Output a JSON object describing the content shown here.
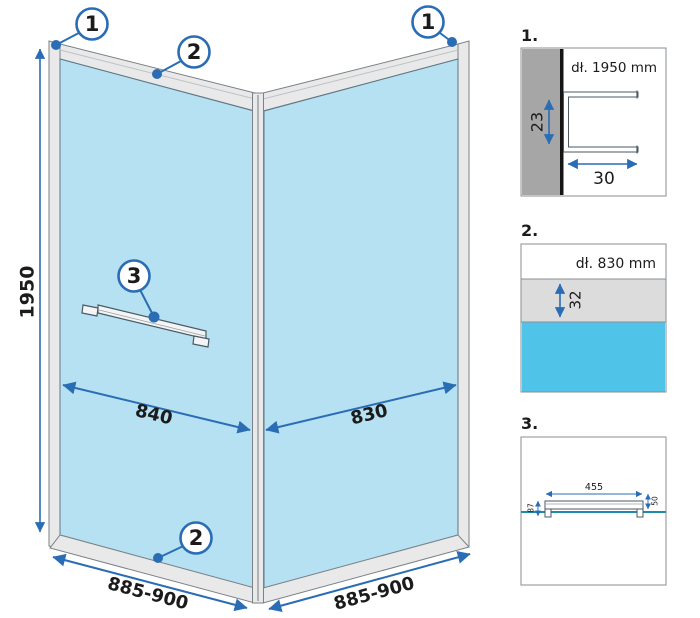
{
  "colors": {
    "accent_blue": "#2a6db5",
    "glass_blue": "#b6e1f2",
    "deep_blue": "#4fc3e8",
    "teal_line": "#1d8cab",
    "wall_gray": "#a6a6a6",
    "band_gray": "#dcdcdc",
    "frame_gray": "#e9e9e9"
  },
  "main": {
    "callout_top_left": "1",
    "callout_top_rail": "2",
    "callout_top_right": "1",
    "callout_shelf": "3",
    "callout_bottom_rail": "2",
    "dim_height": "1950",
    "dim_left_glass": "840",
    "dim_right_glass": "830",
    "dim_left_width": "885-900",
    "dim_right_width": "885-900"
  },
  "detail1": {
    "label": "1.",
    "profile_length": "dł. 1950 mm",
    "dim_depth": "23",
    "dim_width": "30"
  },
  "detail2": {
    "label": "2.",
    "profile_length": "dł. 830 mm",
    "dim_height": "32"
  },
  "detail3": {
    "label": "3.",
    "dim_width": "455",
    "dim_left_height": "87",
    "dim_right_height": "50"
  }
}
